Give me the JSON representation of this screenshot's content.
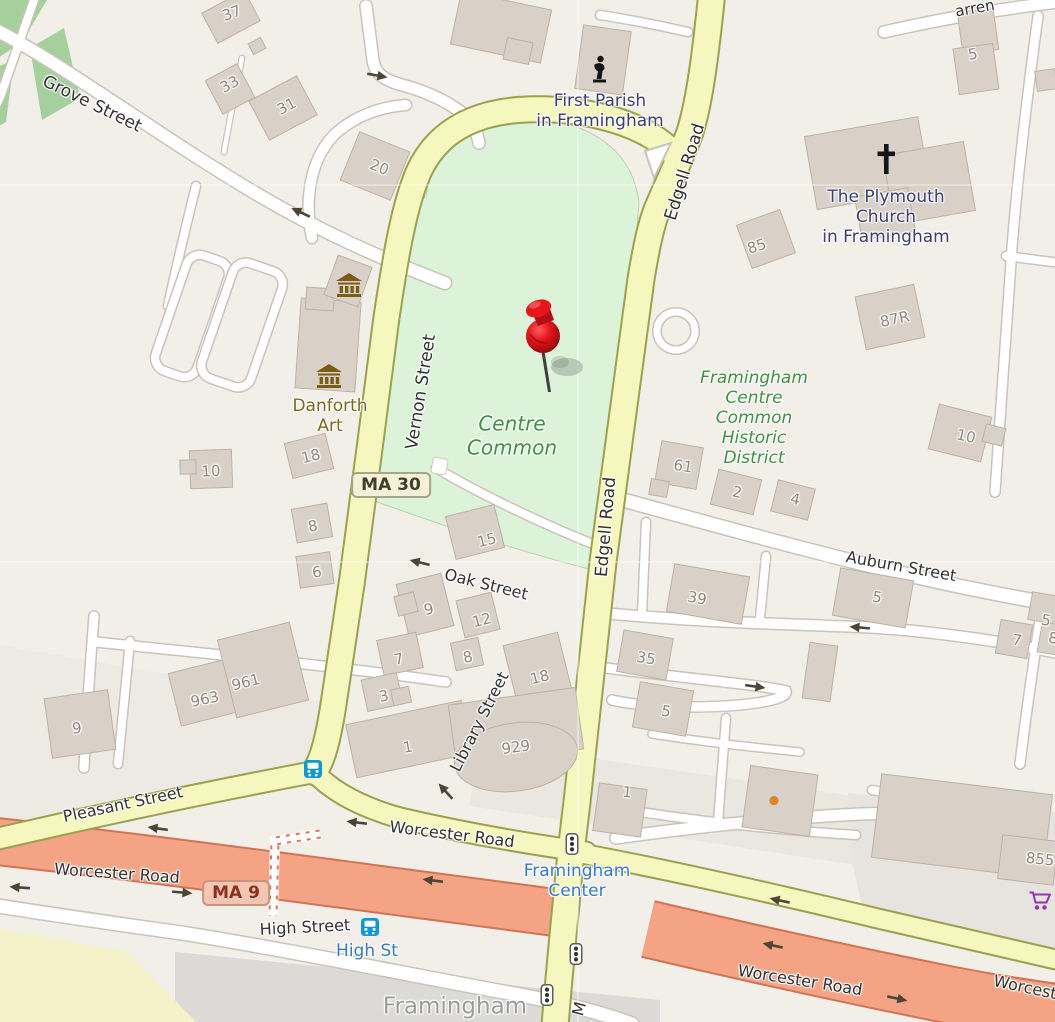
{
  "map": {
    "marker": {
      "name": "dropped-pin",
      "x": 543,
      "y": 336
    },
    "shields": [
      {
        "name": "ma30-shield",
        "label": "MA 30",
        "type": "state",
        "x": 391,
        "y": 485
      },
      {
        "name": "ma9-shield",
        "label": "MA 9",
        "type": "trunk",
        "x": 236,
        "y": 893
      }
    ],
    "streets": [
      {
        "t": "Grove Street",
        "x": 92,
        "y": 104,
        "r": 26,
        "s": 17
      },
      {
        "t": "Vernon Street",
        "x": 421,
        "y": 392,
        "r": -81,
        "s": 17
      },
      {
        "t": "Edgell Road",
        "x": 685,
        "y": 172,
        "r": -73,
        "s": 17
      },
      {
        "t": "Edgell Road",
        "x": 606,
        "y": 527,
        "r": -85,
        "s": 17
      },
      {
        "t": "Oak Street",
        "x": 486,
        "y": 585,
        "r": 14,
        "s": 16
      },
      {
        "t": "Library Street",
        "x": 480,
        "y": 722,
        "r": -63,
        "s": 16
      },
      {
        "t": "Auburn Street",
        "x": 901,
        "y": 567,
        "r": 10,
        "s": 16
      },
      {
        "t": "Pleasant Street",
        "x": 123,
        "y": 805,
        "r": -12,
        "s": 16
      },
      {
        "t": "Worcester Road",
        "x": 452,
        "y": 835,
        "r": 7,
        "s": 16
      },
      {
        "t": "Worcester Road",
        "x": 117,
        "y": 874,
        "r": 4,
        "s": 16
      },
      {
        "t": "High Street",
        "x": 305,
        "y": 928,
        "r": -3,
        "s": 16
      },
      {
        "t": "Worcester Road",
        "x": 800,
        "y": 981,
        "r": 9,
        "s": 16
      },
      {
        "t": "Worcest",
        "x": 1025,
        "y": 988,
        "r": 12,
        "s": 16
      },
      {
        "t": "arren",
        "x": 975,
        "y": 9,
        "r": -10,
        "s": 15
      },
      {
        "t": "M",
        "x": 580,
        "y": 1009,
        "r": -75,
        "s": 16
      }
    ],
    "pois": [
      {
        "name": "first-parish",
        "lines": [
          "First Parish",
          "in Framingham"
        ],
        "x": 600,
        "y": 111,
        "cls": "rel"
      },
      {
        "name": "plymouth-church",
        "lines": [
          "The Plymouth",
          "Church",
          "in Framingham"
        ],
        "x": 886,
        "y": 217,
        "cls": "rel"
      },
      {
        "name": "danforth-art",
        "lines": [
          "Danforth",
          "Art"
        ],
        "x": 330,
        "y": 416,
        "cls": "brown"
      },
      {
        "name": "centre-common",
        "lines": [
          "Centre",
          "Common"
        ],
        "x": 512,
        "y": 436,
        "cls": "park"
      },
      {
        "name": "historic-district",
        "lines": [
          "Framingham",
          "Centre",
          "Common",
          "Historic",
          "District"
        ],
        "x": 754,
        "y": 418,
        "cls": "hist"
      },
      {
        "name": "framingham-center",
        "lines": [
          "Framingham",
          "Center"
        ],
        "x": 577,
        "y": 881,
        "cls": "blue"
      },
      {
        "name": "high-st-stop",
        "lines": [
          "High St"
        ],
        "x": 367,
        "y": 951,
        "cls": "blue"
      },
      {
        "name": "framingham-city",
        "lines": [
          "Framingham"
        ],
        "x": 455,
        "y": 1007,
        "cls": "city"
      }
    ],
    "numbers": [
      {
        "t": "37",
        "x": 232,
        "y": 14,
        "r": -20
      },
      {
        "t": "33",
        "x": 230,
        "y": 85,
        "r": -28
      },
      {
        "t": "31",
        "x": 287,
        "y": 107,
        "r": -28
      },
      {
        "t": "20",
        "x": 379,
        "y": 168,
        "r": 22
      },
      {
        "t": "5",
        "x": 973,
        "y": 55,
        "r": -10
      },
      {
        "t": "85",
        "x": 757,
        "y": 247,
        "r": -18
      },
      {
        "t": "87R",
        "x": 895,
        "y": 320,
        "r": -12
      },
      {
        "t": "10",
        "x": 966,
        "y": 437,
        "r": 12
      },
      {
        "t": "18",
        "x": 311,
        "y": 457,
        "r": -14
      },
      {
        "t": "10",
        "x": 211,
        "y": 472,
        "r": -3
      },
      {
        "t": "8",
        "x": 313,
        "y": 527,
        "r": -10
      },
      {
        "t": "6",
        "x": 317,
        "y": 573,
        "r": -8
      },
      {
        "t": "15",
        "x": 487,
        "y": 541,
        "r": -14
      },
      {
        "t": "9",
        "x": 429,
        "y": 610,
        "r": -14
      },
      {
        "t": "12",
        "x": 482,
        "y": 621,
        "r": -14
      },
      {
        "t": "7",
        "x": 399,
        "y": 660,
        "r": -12
      },
      {
        "t": "8",
        "x": 468,
        "y": 658,
        "r": -12
      },
      {
        "t": "3",
        "x": 384,
        "y": 697,
        "r": -12
      },
      {
        "t": "18",
        "x": 540,
        "y": 678,
        "r": -14
      },
      {
        "t": "1",
        "x": 408,
        "y": 748,
        "r": -10
      },
      {
        "t": "929",
        "x": 516,
        "y": 748,
        "r": -8
      },
      {
        "t": "39",
        "x": 697,
        "y": 599,
        "r": 10
      },
      {
        "t": "35",
        "x": 646,
        "y": 659,
        "r": 9
      },
      {
        "t": "5",
        "x": 666,
        "y": 712,
        "r": 9
      },
      {
        "t": "61",
        "x": 683,
        "y": 467,
        "r": 9
      },
      {
        "t": "2",
        "x": 737,
        "y": 493,
        "r": 12
      },
      {
        "t": "4",
        "x": 795,
        "y": 500,
        "r": 12
      },
      {
        "t": "5",
        "x": 877,
        "y": 598,
        "r": 9
      },
      {
        "t": "7",
        "x": 1017,
        "y": 641,
        "r": 9
      },
      {
        "t": "8",
        "x": 1053,
        "y": 639,
        "r": 9
      },
      {
        "t": "5",
        "x": 1046,
        "y": 621,
        "r": 9
      },
      {
        "t": "1",
        "x": 627,
        "y": 793,
        "r": 6
      },
      {
        "t": "963",
        "x": 205,
        "y": 700,
        "r": -12
      },
      {
        "t": "961",
        "x": 246,
        "y": 683,
        "r": -14
      },
      {
        "t": "9",
        "x": 77,
        "y": 729,
        "r": -6
      },
      {
        "t": "855",
        "x": 1040,
        "y": 860,
        "r": 6
      }
    ],
    "arrows": [
      {
        "x": 377,
        "y": 76,
        "r": 10
      },
      {
        "x": 301,
        "y": 212,
        "r": 205
      },
      {
        "x": 420,
        "y": 562,
        "r": 194
      },
      {
        "x": 446,
        "y": 791,
        "r": 228
      },
      {
        "x": 860,
        "y": 627,
        "r": 185
      },
      {
        "x": 755,
        "y": 687,
        "r": 8
      },
      {
        "x": 158,
        "y": 828,
        "r": 188
      },
      {
        "x": 433,
        "y": 880,
        "r": 187
      },
      {
        "x": 182,
        "y": 893,
        "r": 5
      },
      {
        "x": 357,
        "y": 822,
        "r": 187
      },
      {
        "x": 20,
        "y": 887,
        "r": 184
      },
      {
        "x": 780,
        "y": 900,
        "r": 192
      },
      {
        "x": 773,
        "y": 945,
        "r": 192
      },
      {
        "x": 897,
        "y": 999,
        "r": 12
      }
    ],
    "icons": [
      {
        "name": "museum-icon",
        "x": 349,
        "y": 287
      },
      {
        "name": "museum-icon",
        "x": 329,
        "y": 378
      },
      {
        "name": "church-cross-icon",
        "x": 886,
        "y": 161
      },
      {
        "name": "memorial-icon",
        "x": 599,
        "y": 71
      },
      {
        "name": "bus-stop-icon",
        "x": 313,
        "y": 771
      },
      {
        "name": "bus-stop-icon",
        "x": 370,
        "y": 929
      },
      {
        "name": "traffic-signal-icon",
        "x": 572,
        "y": 846
      },
      {
        "name": "traffic-signal-icon",
        "x": 576,
        "y": 956
      },
      {
        "name": "traffic-signal-icon",
        "x": 547,
        "y": 997
      },
      {
        "name": "shopping-cart-icon",
        "x": 1040,
        "y": 903
      },
      {
        "name": "poi-dot-icon",
        "x": 774,
        "y": 801
      }
    ],
    "colors": {
      "land": "#f2efe9",
      "park_green": "#dcf3da",
      "woods_green": "#a5cf9d",
      "secondary_road": "#f6f7be",
      "secondary_casing": "#9aa14f",
      "trunk_road": "#f5a385",
      "trunk_casing": "#d07455",
      "building": "#d9d1c8",
      "marker_red": "#e3141b",
      "bus_blue": "#0c98dc",
      "cart_purple": "#9333b5",
      "poi_religious_text": "#3c3c72",
      "poi_park_text": "#3f9143",
      "transit_text": "#3579cb"
    }
  }
}
